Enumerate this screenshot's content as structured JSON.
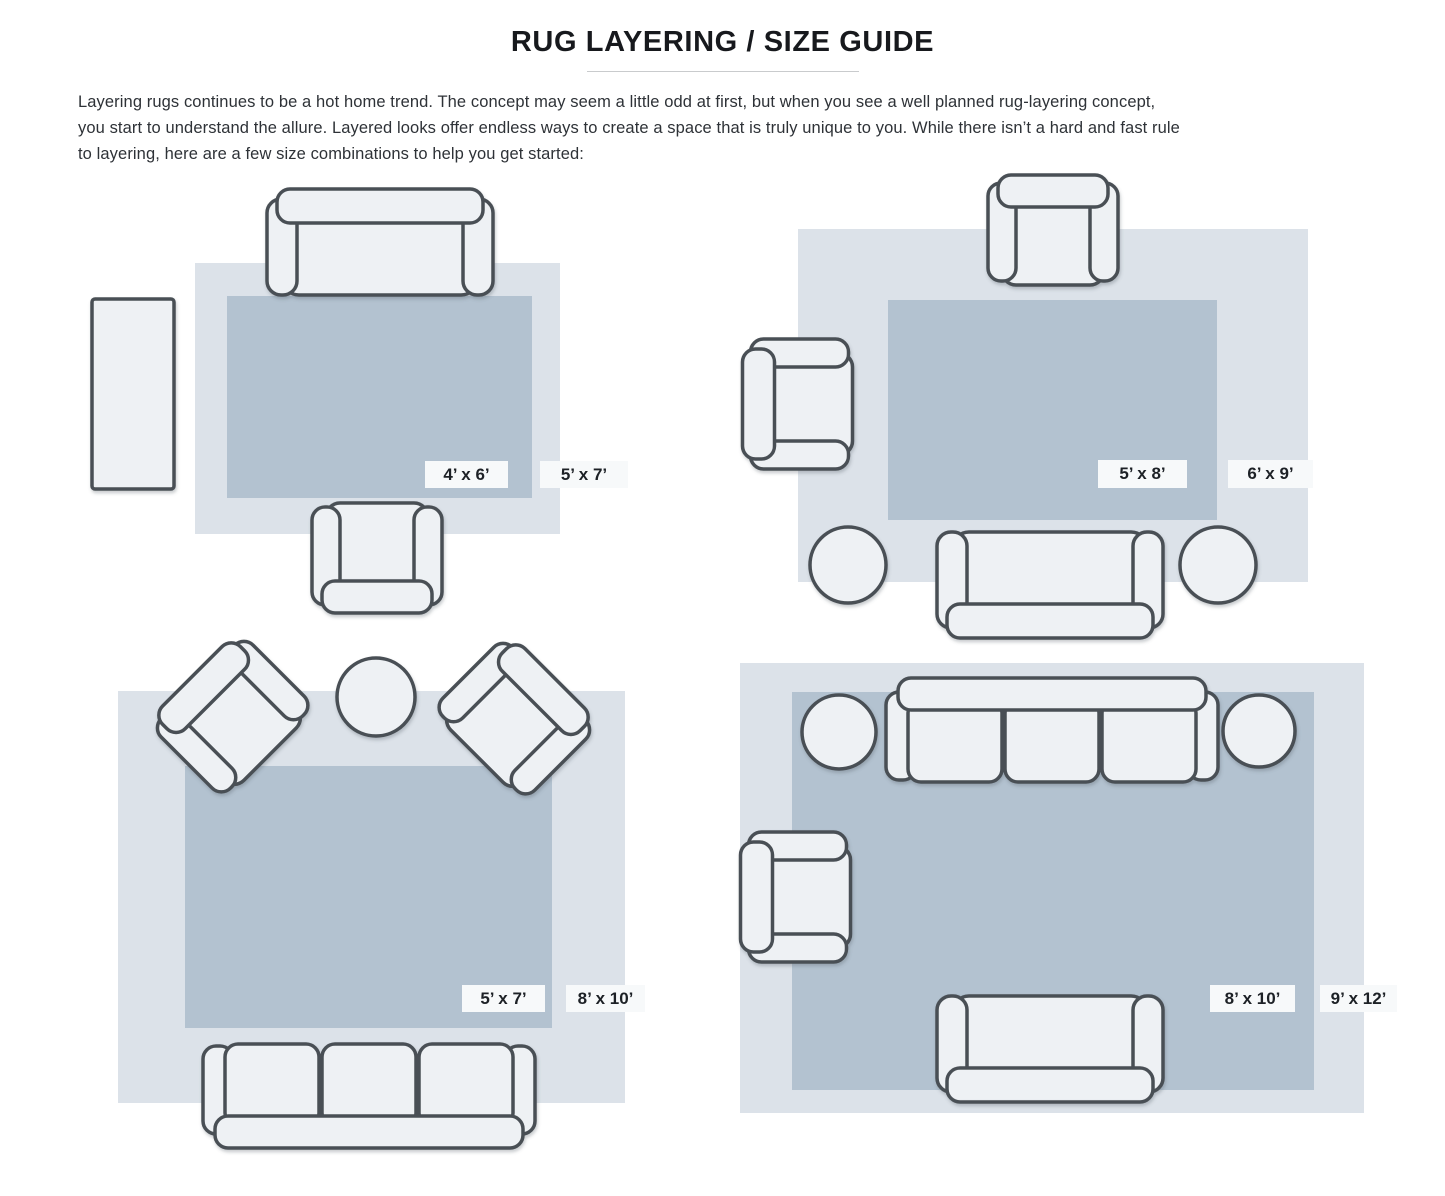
{
  "page": {
    "title": "RUG LAYERING / SIZE GUIDE",
    "intro_lines": [
      "Layering rugs continues to be a hot home trend. The concept may seem a little odd at first, but when you see a well planned rug-layering concept,",
      "you start to understand the allure. Layered looks offer endless ways to create a space that is truly unique to you. While there isn’t a hard and fast rule",
      "to layering, here are a few size combinations to help you get started:"
    ]
  },
  "colors": {
    "outer_rug": "#dce2e9",
    "inner_rug": "#b3c2d0",
    "furniture_fill": "#eef1f4",
    "furniture_stroke": "#4a5055",
    "label_bg": "#f7f9fa",
    "label_text": "#1d2126"
  },
  "diagrams": [
    {
      "name": "top-left",
      "inner_rug_size": "4’ x 6’",
      "outer_rug_size": "5’ x 7’",
      "furniture": [
        "loveseat-sofa",
        "armchair",
        "console-runner"
      ]
    },
    {
      "name": "top-right",
      "inner_rug_size": "5’ x 8’",
      "outer_rug_size": "6’ x 9’",
      "furniture": [
        "armchair",
        "armchair",
        "loveseat-sofa",
        "round-side-table",
        "round-side-table"
      ]
    },
    {
      "name": "bottom-left",
      "inner_rug_size": "5’ x 7’",
      "outer_rug_size": "8’ x 10’",
      "furniture": [
        "angled-armchair",
        "round-side-table",
        "angled-armchair",
        "three-seat-sofa"
      ]
    },
    {
      "name": "bottom-right",
      "inner_rug_size": "8’ x 10’",
      "outer_rug_size": "9’ x 12’",
      "furniture": [
        "three-seat-sofa",
        "round-side-table",
        "round-side-table",
        "armchair",
        "loveseat-sofa"
      ]
    }
  ]
}
